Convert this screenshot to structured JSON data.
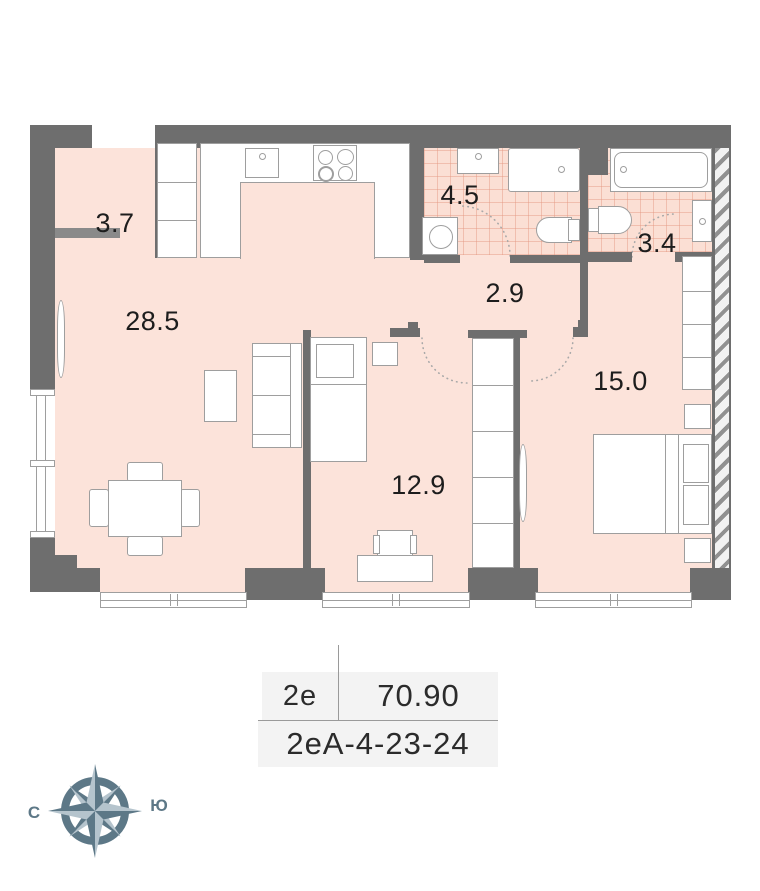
{
  "plan_title": "apartment floor plan",
  "rooms": [
    {
      "name": "hallway",
      "area": "3.7"
    },
    {
      "name": "kitchen-living-room",
      "area": "28.5"
    },
    {
      "name": "bathroom",
      "area": "4.5"
    },
    {
      "name": "corridor",
      "area": "2.9"
    },
    {
      "name": "bathroom-2",
      "area": "3.4"
    },
    {
      "name": "bedroom",
      "area": "15.0"
    },
    {
      "name": "bedroom-2",
      "area": "12.9"
    }
  ],
  "info_table": {
    "unit_type": "2е",
    "total_area": "70.90",
    "unit_code": "2еА-4-23-24"
  },
  "compass": {
    "icon": "compass-rose-icon",
    "left_label": "С",
    "right_label": "Ю"
  },
  "colors": {
    "wall": "#6e6e6e",
    "floor": "#fce3da",
    "tile_line": "#e49680",
    "compass_dark": "#5d7887",
    "compass_light": "#b5c4cd",
    "table_background": "#f3f3f3"
  }
}
